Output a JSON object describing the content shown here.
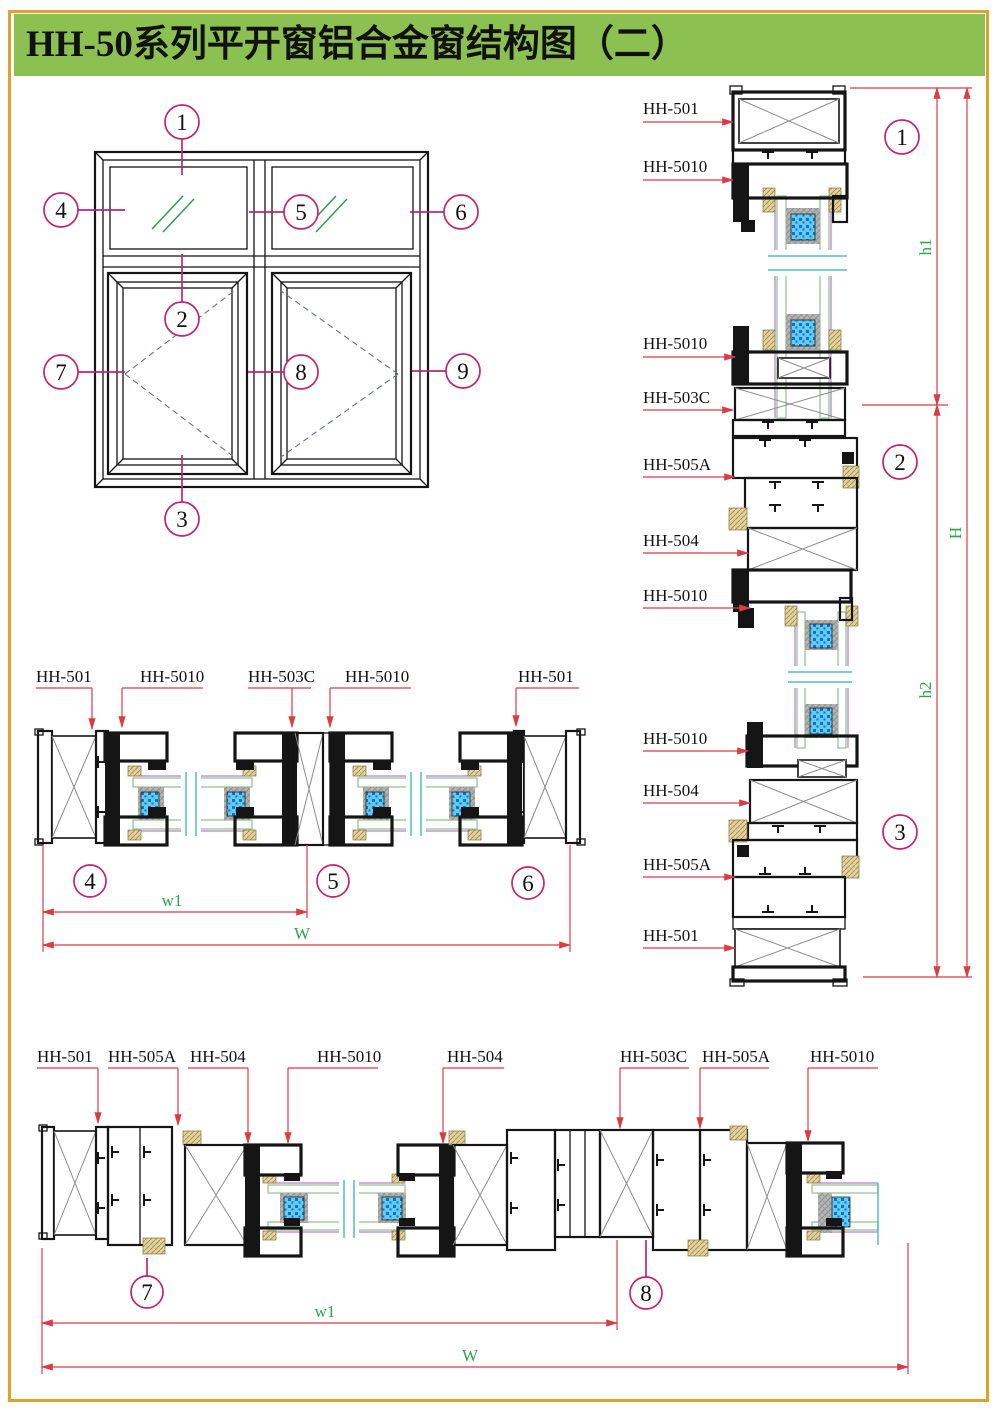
{
  "page": {
    "title": "HH-50系列平开窗铝合金窗结构图（二）",
    "colors": {
      "header_bg": "#8CC152",
      "border": "#DFA32C",
      "callout": "#C12572",
      "leader_red": "#DD3B44",
      "dim_text_green": "#2FA44D"
    }
  },
  "elevation": {
    "callouts": [
      "1",
      "2",
      "3",
      "4",
      "5",
      "6",
      "7",
      "8",
      "9"
    ]
  },
  "vertical_section": {
    "labels": [
      "HH-501",
      "HH-5010",
      "HH-5010",
      "HH-503C",
      "HH-505A",
      "HH-504",
      "HH-5010",
      "HH-5010",
      "HH-504",
      "HH-505A",
      "HH-501"
    ],
    "callouts": [
      "1",
      "2",
      "3"
    ],
    "dims": {
      "h1": "h1",
      "h": "H",
      "h2": "h2"
    }
  },
  "mid_section": {
    "labels": [
      "HH-501",
      "HH-5010",
      "HH-503C",
      "HH-5010",
      "HH-501"
    ],
    "callouts": [
      "4",
      "5",
      "6"
    ],
    "dims": {
      "w1": "w1",
      "w": "W"
    }
  },
  "bottom_section": {
    "labels": [
      "HH-501",
      "HH-505A",
      "HH-504",
      "HH-5010",
      "HH-504",
      "HH-503C",
      "HH-505A",
      "HH-5010"
    ],
    "callouts": [
      "7",
      "8"
    ],
    "dims": {
      "w1": "w1",
      "w": "W"
    }
  }
}
